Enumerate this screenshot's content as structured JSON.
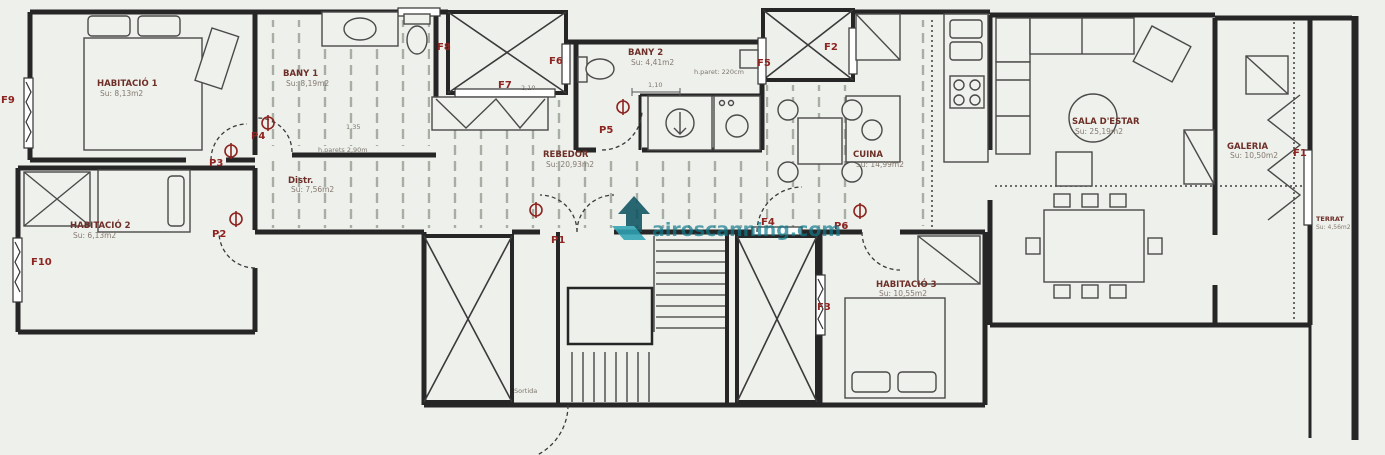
{
  "drawing": {
    "kind": "architectural floor plan",
    "language": "Catalan"
  },
  "rooms": [
    {
      "name": "HABITACIÓ 1",
      "area": "Su: 8,13m2"
    },
    {
      "name": "BANY 1",
      "area": "Su: 8,19m2"
    },
    {
      "name": "BANY 2",
      "area": "Su: 4,41m2"
    },
    {
      "name": "REBEDOR",
      "area": "Su: 20,93m2"
    },
    {
      "name": "Distr.",
      "area": "Su: 7,56m2"
    },
    {
      "name": "CUINA",
      "area": "Su: 14,99m2"
    },
    {
      "name": "SALA D'ESTAR",
      "area": "Su: 25,19m2"
    },
    {
      "name": "GALERIA",
      "area": "Su: 10,50m2"
    },
    {
      "name": "TERRAT",
      "area": "Su: 4,56m2"
    },
    {
      "name": "HABITACIÓ 2",
      "area": "Su: 6,13m2"
    },
    {
      "name": "HABITACIÓ 3",
      "area": "Su: 10,55m2"
    }
  ],
  "windows": [
    "F1",
    "F2",
    "F3",
    "F4",
    "F5",
    "F6",
    "F7",
    "F8",
    "F9",
    "F10"
  ],
  "doors": [
    "P1",
    "P2",
    "P3",
    "P4",
    "P5",
    "P6"
  ],
  "annotations": {
    "wall_height_main": "h.parets 2,90m",
    "wall_height_bany2": "h.paret: 220cm",
    "dim_135": "1,35",
    "dim_110": "1,10",
    "dim_210": "2,10",
    "exit": "Sortida"
  },
  "watermark": {
    "text": "airoscanning.com"
  },
  "colors": {
    "background": "#eef0ec",
    "walls": "#262626",
    "label_red": "#8e2420",
    "room_name": "#6e2f28",
    "room_area": "#85796f",
    "dashed_lines": "#a8aea4",
    "furniture": "#4a4a4a",
    "watermark_teal": "#117b8e"
  }
}
